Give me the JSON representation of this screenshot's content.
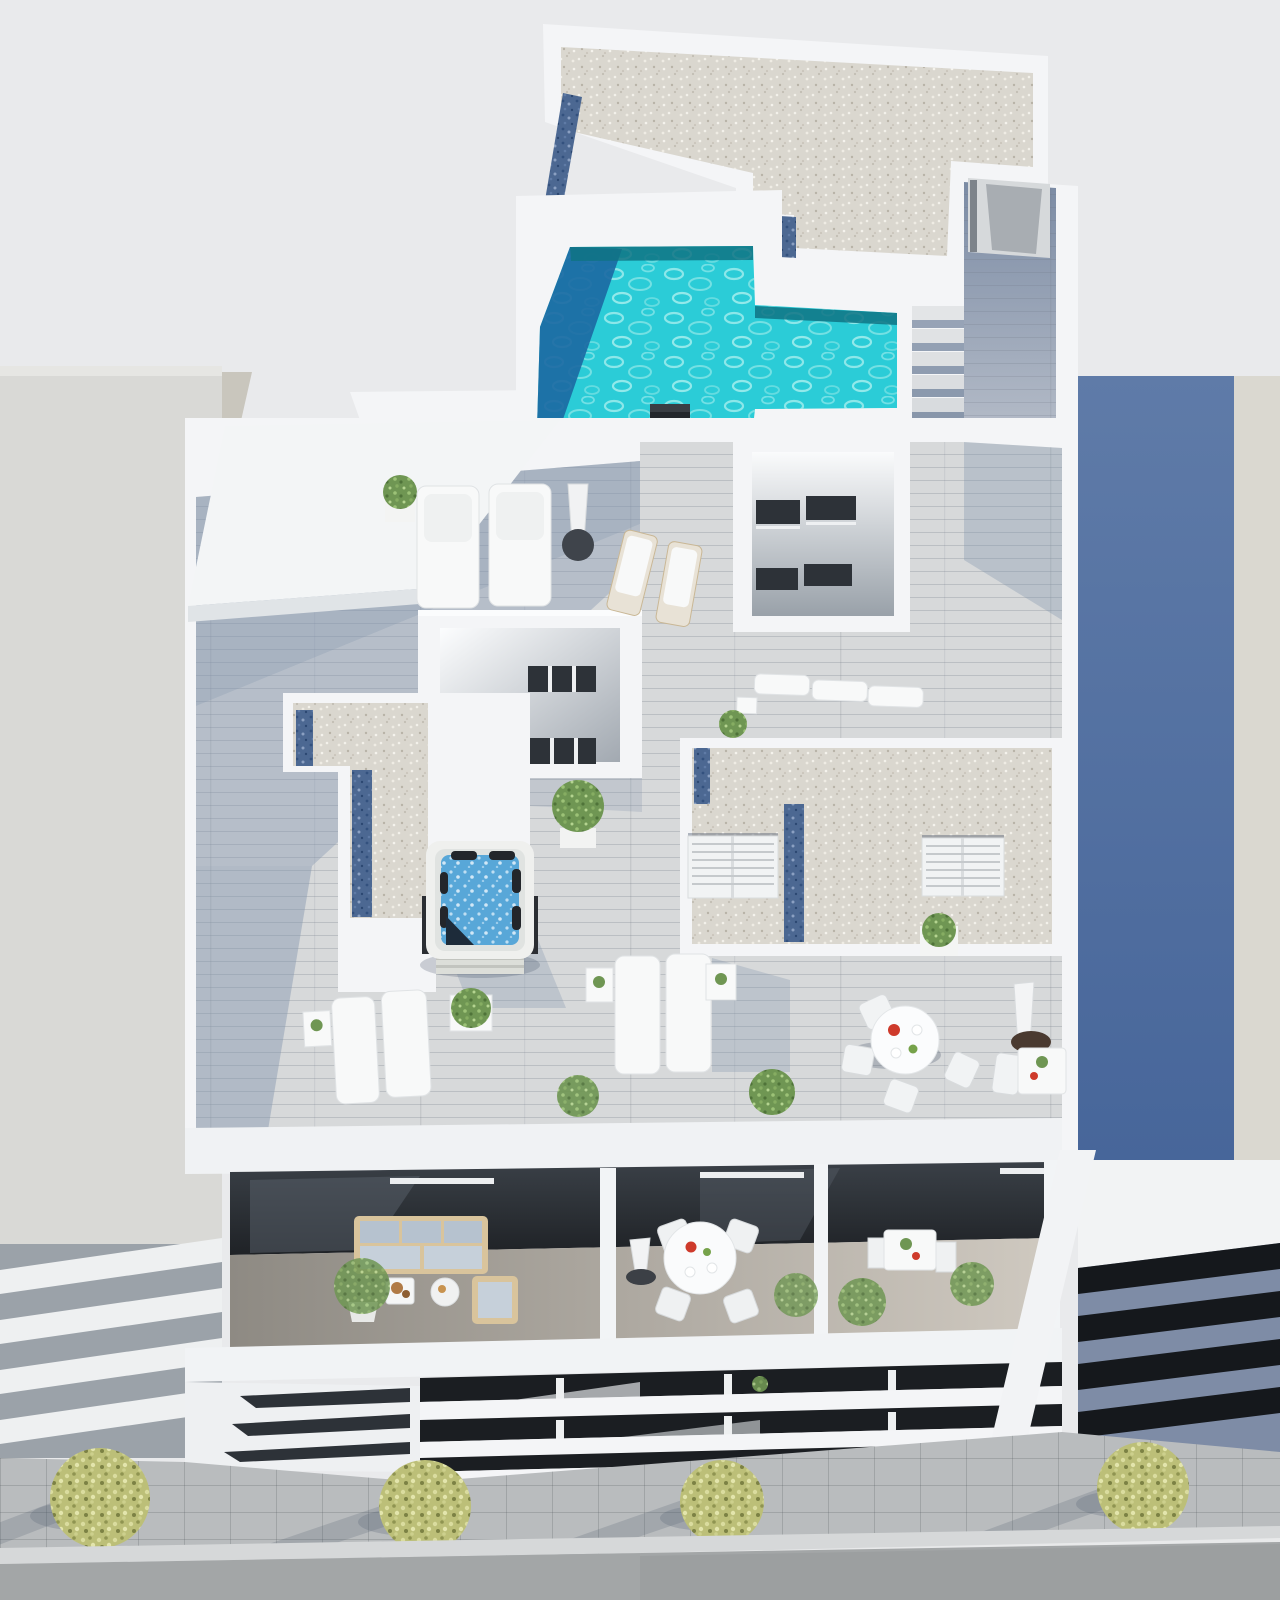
{
  "window": {
    "width": 1280,
    "height": 1600,
    "kind": "3D architectural aerial rendering",
    "subject": "Bird's-eye view of a white apartment building rooftop solarium with L-shaped pool, hot tub, timber deck terraces, furnished balconies and street below"
  },
  "palette": {
    "bg": "#e9eaec",
    "building-white": "#f4f5f7",
    "building-white-dim": "#e8ebee",
    "parapet-shade": "#dde1e5",
    "neighbor-left": "#d9d9d6",
    "neighbor-left-dark": "#c9c6bd",
    "neighbor-right-blue-top": "#5f7ba8",
    "neighbor-right-blue-bottom": "#47669a",
    "neighbor-right-lit": "#dad8d0",
    "gravel-base": "#dad7cf",
    "gravel-blue": "#4c6892",
    "deck-light": "#d7d9da",
    "deck-shadow": "#8294ad",
    "pool-water": "#2bccd7",
    "pool-shadow": "#1c6aa3",
    "pool-edge": "#0f7384",
    "jacuzzi-water": "#58a7d8",
    "glass-dark": "#2d3238",
    "glass-darker": "#1b1e22",
    "stripe-blue": "#7e8ca6",
    "stripe-dark": "#15181c",
    "sidewalk": "#b9bcbe",
    "road": "#a3a6a7",
    "curb": "#d6d8d9",
    "white-furniture": "#f8f9f9",
    "wood-frame": "#d9c49c",
    "sofa-cushion": "#b6c2cf",
    "plant-green": "#6f9653",
    "tree-leaf": "#bcbf78",
    "accent-red": "#ce3a2b",
    "parasol-base": "#4a3a30",
    "cast-shadow": "#465269"
  },
  "scene": {
    "neighbors": {
      "left": "plain light-gray building with louvered lower floors",
      "right": "blue-gray building with sunlit edge strip and dark glass band facade"
    },
    "rooftop": {
      "features": [
        "white gravel flat roof with blue glass mulch strips",
        "L-shaped turquoise swimming pool",
        "roof access stair corridor with door",
        "dark chimney vent",
        "skylight courtyard boxes with dark window slits",
        "L-shaped gravel planter with blue strips",
        "square hot tub jacuzzi",
        "timber deck sun terraces",
        "louvered shutter skylights"
      ],
      "furniture_counts": {
        "sun_loungers": 11,
        "closed_parasols": 3,
        "round_dining_sets": 2,
        "bistro_tables": 2,
        "side_tables": 7,
        "potted_plants": 12
      }
    },
    "balconies": {
      "count": 3,
      "items": [
        "outdoor sofa with wood frame, coffee table and armchair",
        "round dining table with four chairs and closed parasol",
        "bistro table with two chairs and shrubs"
      ]
    },
    "street": {
      "elements": [
        "paved sidewalk with grid joints",
        "four yellow-green street trees with long cast shadows",
        "asphalt road with curb and lane line"
      ]
    }
  }
}
